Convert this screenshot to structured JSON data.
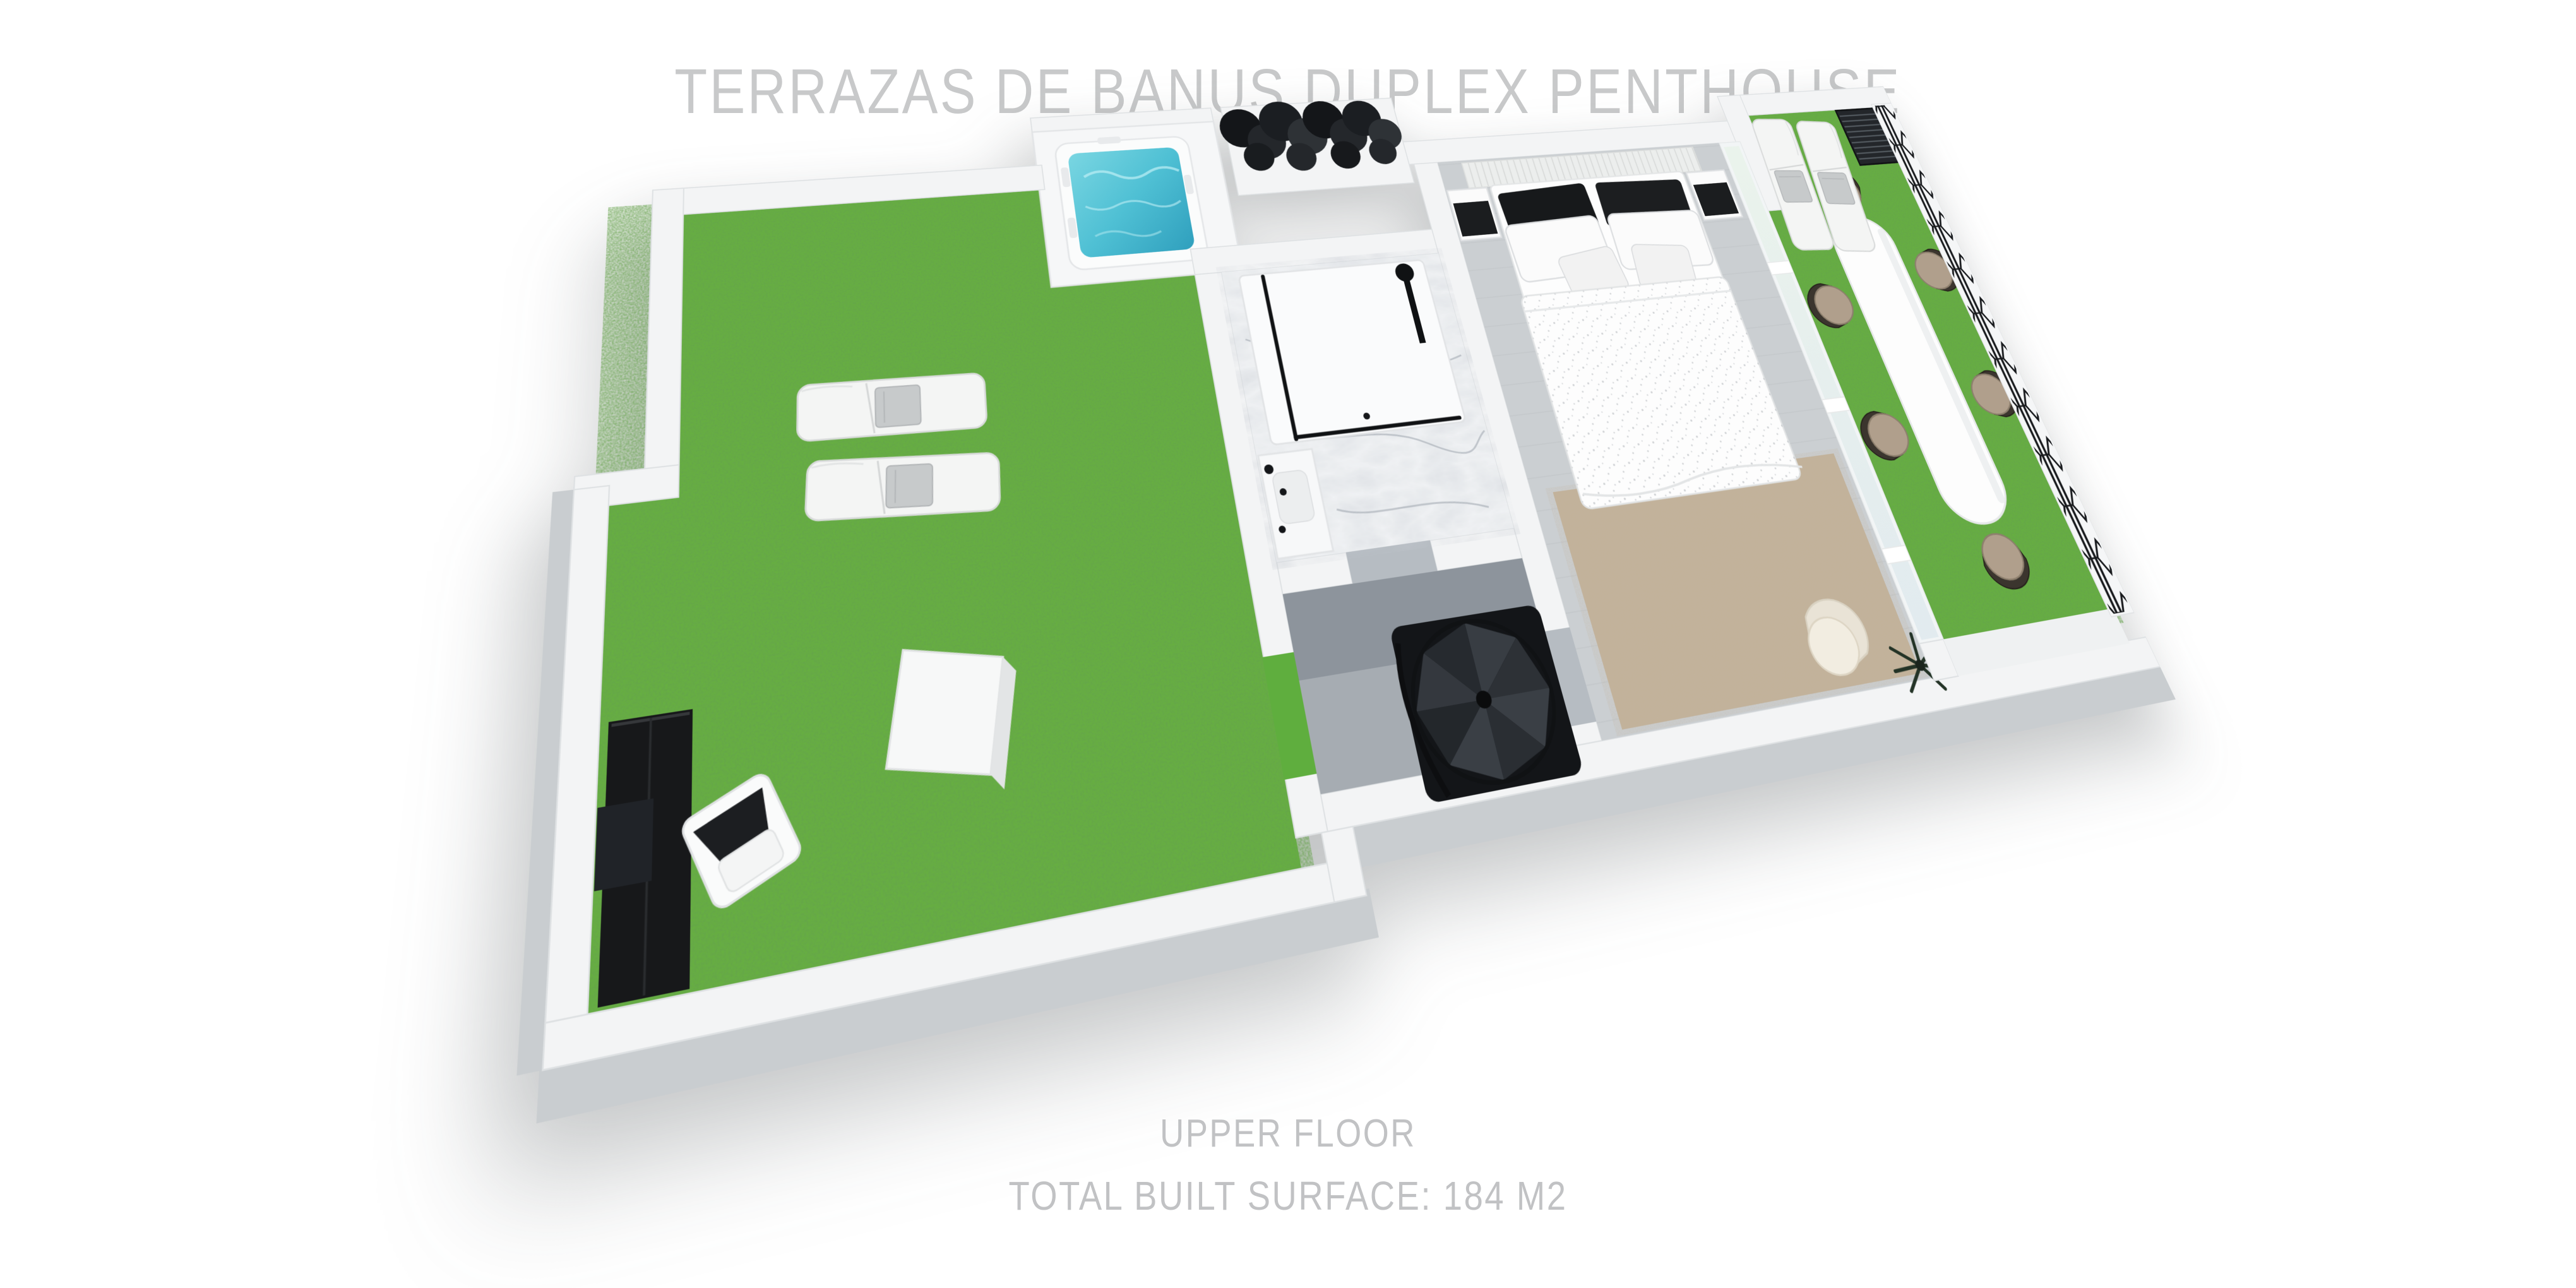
{
  "title": "TERRAZAS DE BANUS DUPLEX PENTHOUSE",
  "footer": {
    "floor_label": "UPPER FLOOR",
    "surface_label": "TOTAL BUILT SURFACE: 184 M2"
  },
  "palette": {
    "title_text": "#c8c9ca",
    "footer_text": "#c1c2c4",
    "grass": "#66b23e",
    "water": "#4fc0d4",
    "wall": "#f3f4f5",
    "wall_shade": "#c9cdd0",
    "marble_floor": "#f0f2f4",
    "bedroom_floor": "#cbcfd2",
    "hall_floor": "#a6acb2",
    "hall_slab": "#8d949c",
    "rug": "#c2b198",
    "ironwork": "#17191c",
    "cushion": "#b09f8c",
    "towel": "#c7cacb",
    "cabinet_black": "#17181a"
  },
  "floorplan": {
    "floor_name": "UPPER FLOOR",
    "total_built_surface_m2": 184,
    "rooms": [
      {
        "name": "west-roof-terrace",
        "surface": "artificial-grass"
      },
      {
        "name": "jacuzzi-alcove",
        "surface": "white-deck"
      },
      {
        "name": "bathroom",
        "surface": "marble"
      },
      {
        "name": "stair-hall",
        "surface": "grey-tile"
      },
      {
        "name": "master-bedroom",
        "surface": "grey-floor"
      },
      {
        "name": "dining-terrace",
        "surface": "artificial-grass"
      },
      {
        "name": "ne-lounger-nook",
        "surface": "artificial-grass"
      }
    ],
    "furniture": [
      {
        "name": "sun-lounger",
        "qty": 4
      },
      {
        "name": "jacuzzi",
        "qty": 1
      },
      {
        "name": "planter-hedge",
        "qty": 1
      },
      {
        "name": "storage-box",
        "qty": 1
      },
      {
        "name": "black-outdoor-cabinet",
        "qty": 1
      },
      {
        "name": "white-outdoor-chair",
        "qty": 1
      },
      {
        "name": "cube-side-table",
        "qty": 1
      },
      {
        "name": "walk-in-shower",
        "qty": 1
      },
      {
        "name": "vanity-basin",
        "qty": 1
      },
      {
        "name": "spiral-staircase",
        "qty": 1
      },
      {
        "name": "double-bed",
        "qty": 1
      },
      {
        "name": "nightstand",
        "qty": 2
      },
      {
        "name": "area-rug",
        "qty": 1
      },
      {
        "name": "armchair",
        "qty": 1
      },
      {
        "name": "palm-plant",
        "qty": 1
      },
      {
        "name": "glass-sliding-wall",
        "qty": 1
      },
      {
        "name": "oval-dining-table",
        "qty": 1
      },
      {
        "name": "dining-chair",
        "qty": 6
      },
      {
        "name": "metal-grate-platform",
        "qty": 1
      },
      {
        "name": "iron-railing",
        "qty": 1
      }
    ]
  }
}
